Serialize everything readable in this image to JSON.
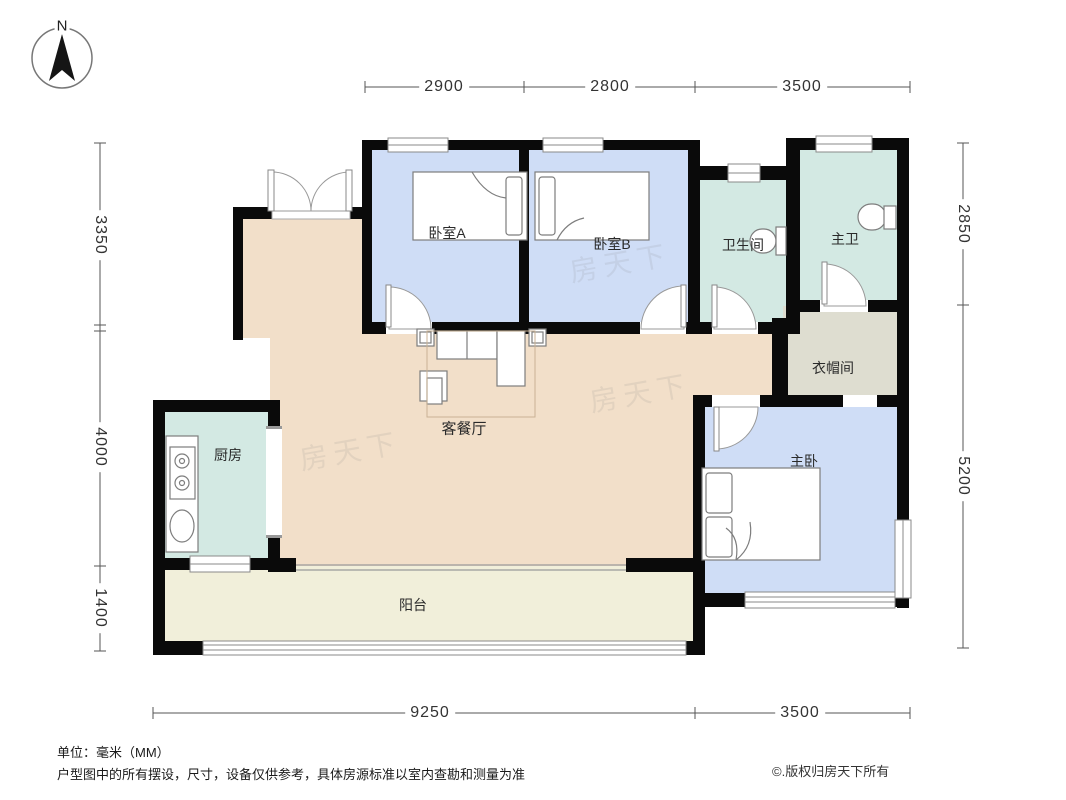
{
  "compass": {
    "label": "N"
  },
  "rooms": {
    "bedroom_a": "卧室A",
    "bedroom_b": "卧室B",
    "bathroom": "卫生间",
    "master_bath": "主卫",
    "cloakroom": "衣帽间",
    "master_bedroom": "主卧",
    "living_dining": "客餐厅",
    "kitchen": "厨房",
    "balcony": "阳台"
  },
  "dimensions": {
    "top": [
      "2900",
      "2800",
      "3500"
    ],
    "left": [
      "3350",
      "4000",
      "1400"
    ],
    "right": [
      "2850",
      "5200"
    ],
    "bottom": [
      "9250",
      "3500"
    ]
  },
  "watermark": "房天下",
  "footer": {
    "unit": "单位：毫米（MM）",
    "disclaimer": "户型图中的所有摆设，尺寸，设备仅供参考，具体房源标准以室内查勘和测量为准",
    "copyright": "©.版权归房天下所有"
  },
  "colors": {
    "bedroom": "#cfddf6",
    "bath": "#d3e9e3",
    "cloakroom": "#deddd0",
    "living": "#f2dfc9",
    "balcony": "#f1efda",
    "wall": "#0a0a0a"
  }
}
